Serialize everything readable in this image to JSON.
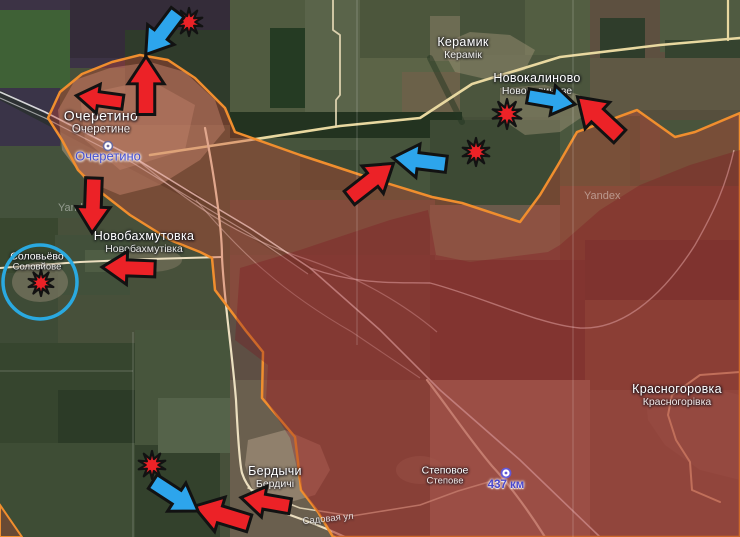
{
  "map": {
    "attribution": "Yandex",
    "labels": [
      {
        "id": "keramik",
        "ru": "Керамик",
        "uk": "Керамік",
        "x": 463,
        "y": 48,
        "size": "md"
      },
      {
        "id": "novokalynove",
        "ru": "Новокалиново",
        "uk": "Новокалинове",
        "x": 537,
        "y": 84,
        "size": "md"
      },
      {
        "id": "ocheretyne",
        "ru": "Очеретино",
        "uk": "Очеретине",
        "x": 101,
        "y": 122,
        "size": "lg"
      },
      {
        "id": "novobakhmutivka",
        "ru": "Новобахмутовка",
        "uk": "Новобахмутівка",
        "x": 144,
        "y": 242,
        "size": "md"
      },
      {
        "id": "solovyove",
        "ru": "Соловьёво",
        "uk": "Соловйове",
        "x": 37,
        "y": 262,
        "size": "sm"
      },
      {
        "id": "berdychi",
        "ru": "Бердычи",
        "uk": "Бердичі",
        "x": 275,
        "y": 477,
        "size": "md"
      },
      {
        "id": "stepove",
        "ru": "Степовое",
        "uk": "Степове",
        "x": 445,
        "y": 476,
        "size": "sm"
      },
      {
        "id": "krasnohorivka",
        "ru": "Красногоровка",
        "uk": "Красногорівка",
        "x": 677,
        "y": 395,
        "size": "md"
      }
    ],
    "station": {
      "name": "Очеретино",
      "x": 108,
      "y": 156,
      "icon_x": 108,
      "icon_y": 146
    },
    "road_marker": {
      "label": "437 км",
      "x": 506,
      "y": 485,
      "pin_x": 506,
      "pin_y": 473
    },
    "street": {
      "label": "Садовая ул",
      "x": 328,
      "y": 519
    }
  },
  "colors": {
    "arrow_red": "#ec2227",
    "arrow_blue": "#2da5ec",
    "symbol_outline": "#121212",
    "zone_border": "#f08e2e",
    "zone_fill": "rgba(205,70,50,0.36)",
    "zone_core_fill": "rgba(125,15,30,0.30)",
    "encircle_blue": "#2aa9e0"
  },
  "symbols": {
    "arrows": [
      {
        "id": "attack-west-of-ocheretyne",
        "color": "red",
        "x": 100,
        "y": 99,
        "len": 47,
        "rot": 188
      },
      {
        "id": "attack-north-ocheretyne",
        "color": "red",
        "x": 146,
        "y": 86,
        "len": 58,
        "rot": -90
      },
      {
        "id": "attack-south-ocheretyne",
        "color": "red",
        "x": 93,
        "y": 205,
        "len": 55,
        "rot": 92
      },
      {
        "id": "attack-novobakhmutivka",
        "color": "red",
        "x": 129,
        "y": 268,
        "len": 53,
        "rot": 182
      },
      {
        "id": "attack-center-northeast",
        "color": "red",
        "x": 371,
        "y": 181,
        "len": 56,
        "rot": -38
      },
      {
        "id": "attack-novokalynove",
        "color": "red",
        "x": 599,
        "y": 117,
        "len": 58,
        "rot": -137
      },
      {
        "id": "attack-berdychi-west-1",
        "color": "red",
        "x": 266,
        "y": 502,
        "len": 50,
        "rot": 190
      },
      {
        "id": "attack-berdychi-west-2",
        "color": "red",
        "x": 222,
        "y": 515,
        "len": 58,
        "rot": 197
      },
      {
        "id": "counter-north",
        "color": "blue",
        "x": 162,
        "y": 33,
        "len": 53,
        "rot": 127
      },
      {
        "id": "counter-center",
        "color": "blue",
        "x": 420,
        "y": 161,
        "len": 54,
        "rot": 187
      },
      {
        "id": "counter-novokalynove",
        "color": "blue",
        "x": 551,
        "y": 100,
        "len": 48,
        "rot": 10
      },
      {
        "id": "counter-berdychi",
        "color": "blue",
        "x": 175,
        "y": 496,
        "len": 54,
        "rot": 33
      }
    ],
    "explosions": [
      {
        "id": "strike-north",
        "x": 189,
        "y": 22,
        "r": 14
      },
      {
        "id": "strike-novokalynove-1",
        "x": 507,
        "y": 114,
        "r": 15
      },
      {
        "id": "strike-novokalynove-2",
        "x": 476,
        "y": 152,
        "r": 14
      },
      {
        "id": "strike-solovyove",
        "x": 41,
        "y": 283,
        "r": 13
      },
      {
        "id": "strike-berdychi",
        "x": 152,
        "y": 465,
        "r": 14
      }
    ],
    "encirclement": {
      "cx": 40,
      "cy": 282,
      "r": 37
    }
  }
}
